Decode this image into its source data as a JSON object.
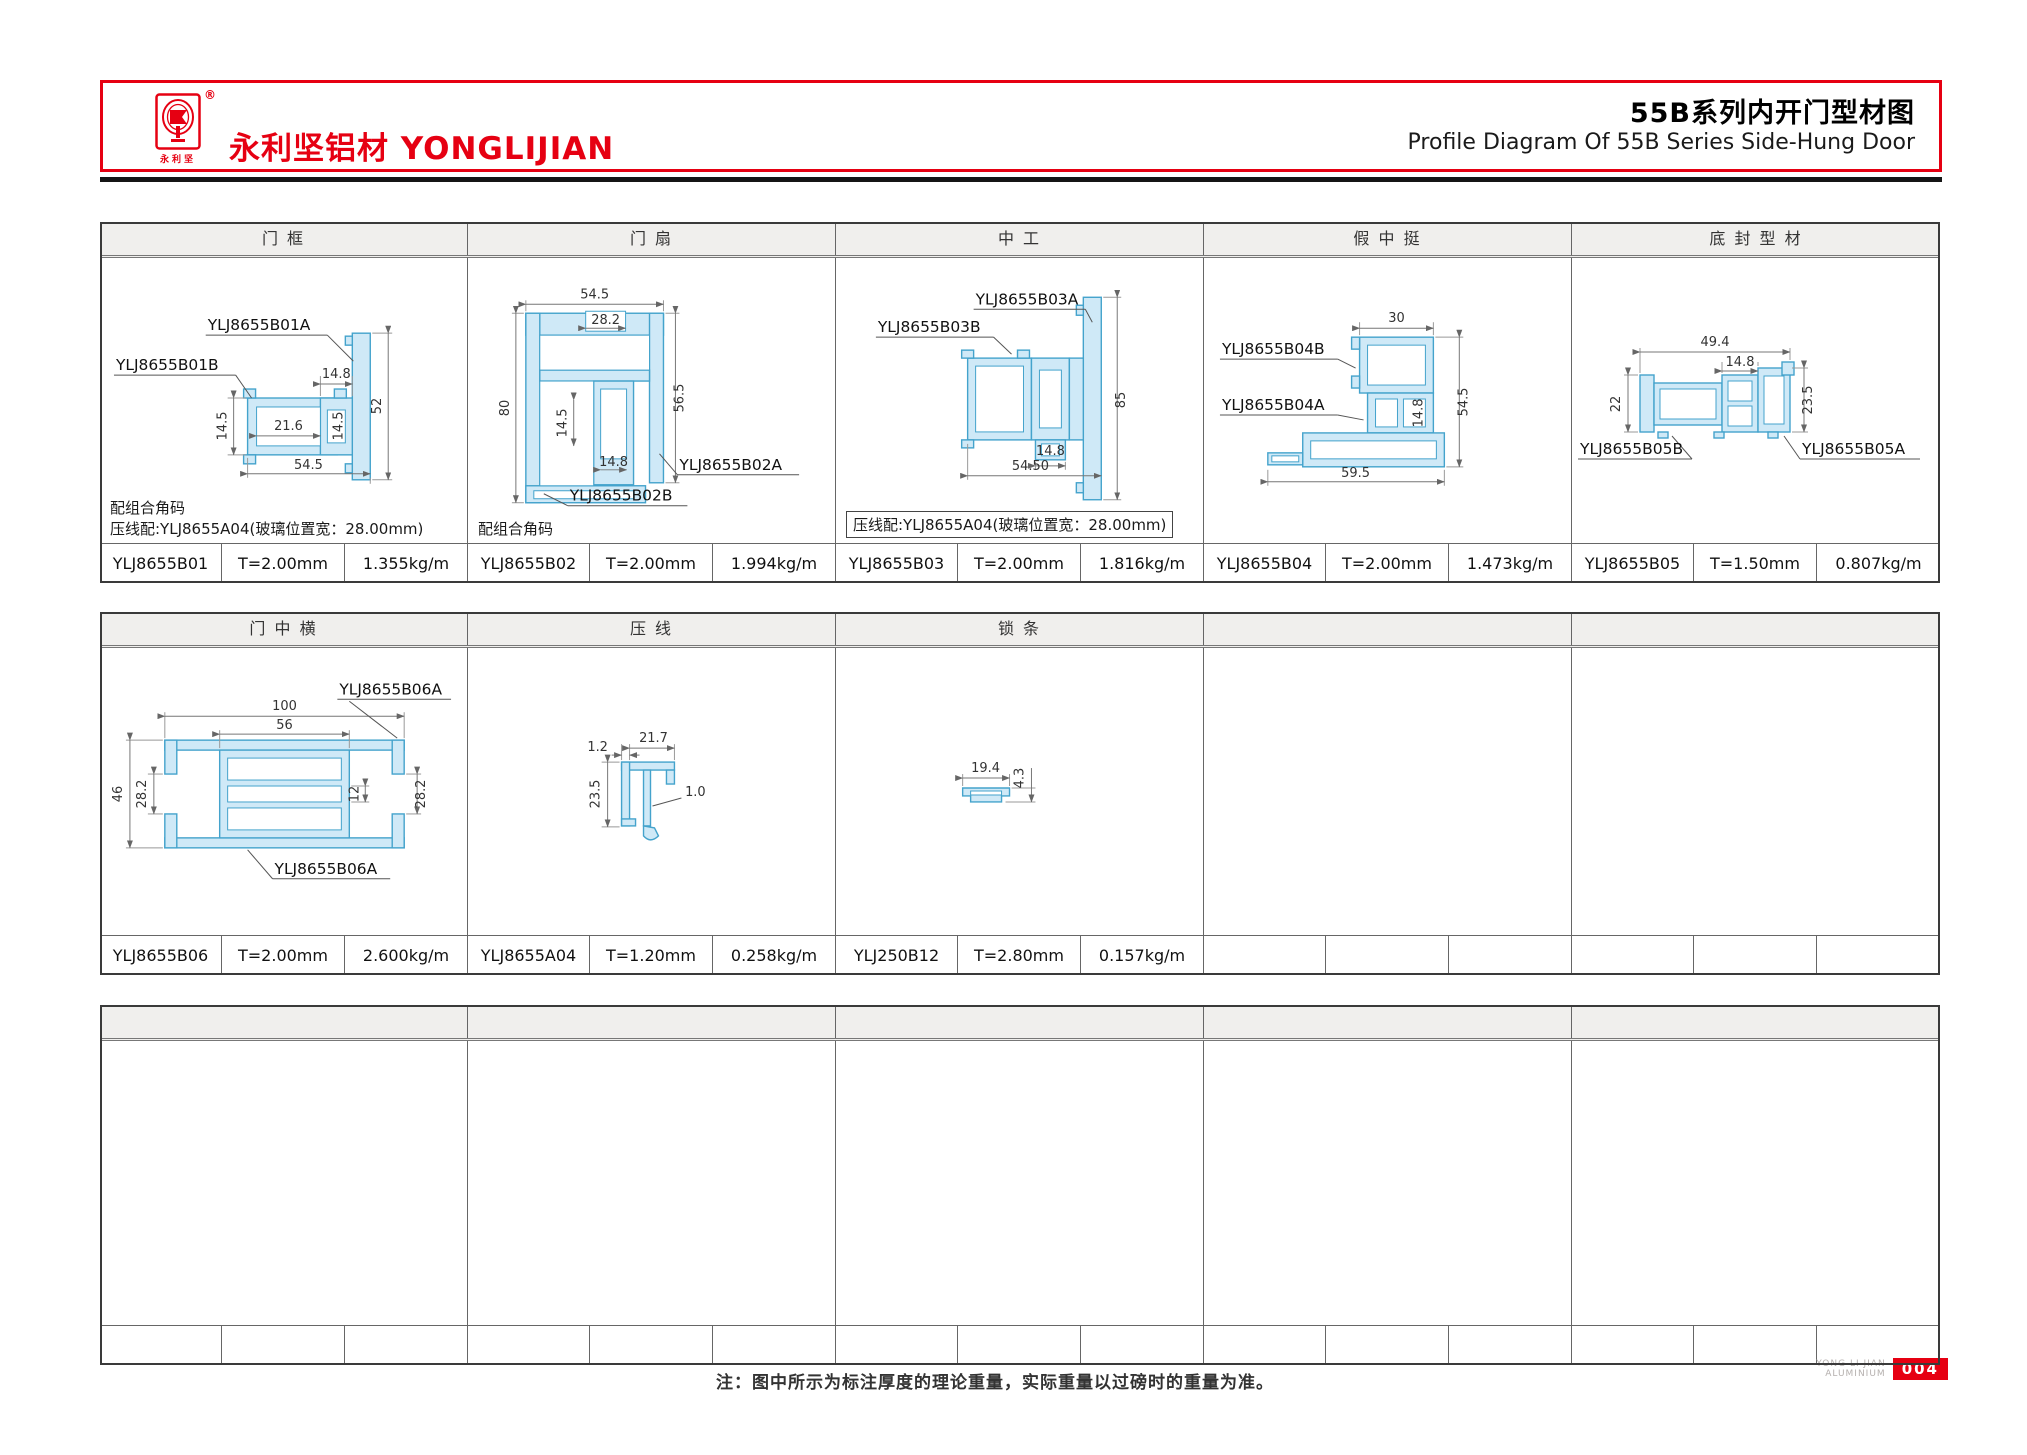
{
  "header": {
    "brand_cn": "永利坚铝材",
    "brand_en": "YONGLIJIAN",
    "brand_small": "永利坚",
    "registered_mark": "®",
    "title_cn": "55B系列内开门型材图",
    "title_en": "Profile Diagram Of 55B Series Side-Hung Door"
  },
  "colors": {
    "accent_red": "#e60012",
    "profile_fill": "#cfe9f7",
    "profile_stroke": "#44a3cc",
    "header_cell_bg": "#f0efed"
  },
  "block1": {
    "headers": [
      "门 框",
      "门 扇",
      "中 工",
      "假 中 挺",
      "底 封 型 材"
    ],
    "notes": {
      "col1_line1": "配组合角码",
      "col1_line2": "压线配:YLJ8655A04(玻璃位置宽：28.00mm)",
      "col2_line1": "配组合角码",
      "col3_boxed": "压线配:YLJ8655A04(玻璃位置宽：28.00mm)"
    },
    "rows": [
      {
        "code": "YLJ8655B01",
        "thickness": "T=2.00mm",
        "weight": "1.355kg/m"
      },
      {
        "code": "YLJ8655B02",
        "thickness": "T=2.00mm",
        "weight": "1.994kg/m"
      },
      {
        "code": "YLJ8655B03",
        "thickness": "T=2.00mm",
        "weight": "1.816kg/m"
      },
      {
        "code": "YLJ8655B04",
        "thickness": "T=2.00mm",
        "weight": "1.473kg/m"
      },
      {
        "code": "YLJ8655B05",
        "thickness": "T=1.50mm",
        "weight": "0.807kg/m"
      }
    ]
  },
  "block2": {
    "headers": [
      "门 中 横",
      "压 线",
      "锁 条",
      "",
      ""
    ],
    "rows": [
      {
        "code": "YLJ8655B06",
        "thickness": "T=2.00mm",
        "weight": "2.600kg/m"
      },
      {
        "code": "YLJ8655A04",
        "thickness": "T=1.20mm",
        "weight": "0.258kg/m"
      },
      {
        "code": "YLJ250B12",
        "thickness": "T=2.80mm",
        "weight": "0.157kg/m"
      }
    ]
  },
  "diagrams": {
    "b01": {
      "labels": [
        "YLJ8655B01A",
        "YLJ8655B01B"
      ],
      "dims": [
        "14.8",
        "52",
        "14.5",
        "21.6",
        "14.5",
        "54.5"
      ]
    },
    "b02": {
      "labels": [
        "YLJ8655B02A",
        "YLJ8655B02B"
      ],
      "dims": [
        "54.5",
        "28.2",
        "80",
        "56.5",
        "14.5",
        "14.8"
      ]
    },
    "b03": {
      "labels": [
        "YLJ8655B03A",
        "YLJ8655B03B"
      ],
      "dims": [
        "85",
        "14.8",
        "54.50"
      ]
    },
    "b04": {
      "labels": [
        "YLJ8655B04B",
        "YLJ8655B04A"
      ],
      "dims": [
        "30",
        "54.5",
        "14.8",
        "59.5"
      ]
    },
    "b05": {
      "labels": [
        "YLJ8655B05B",
        "YLJ8655B05A"
      ],
      "dims": [
        "49.4",
        "14.8",
        "22",
        "23.5"
      ]
    },
    "b06": {
      "labels": [
        "YLJ8655B06A",
        "YLJ8655B06A"
      ],
      "dims": [
        "100",
        "56",
        "46",
        "28.2",
        "12",
        "28.2"
      ]
    },
    "a04": {
      "dims": [
        "1.2",
        "21.7",
        "23.5",
        "1.0"
      ]
    },
    "b12": {
      "dims": [
        "19.4",
        "4.3"
      ]
    }
  },
  "footer": {
    "note": "注：图中所示为标注厚度的理论重量，实际重量以过磅时的重量为准。",
    "brand_line1": "YONG LI JIAN",
    "brand_line2": "ALUMINIUM",
    "page_number": "004"
  }
}
